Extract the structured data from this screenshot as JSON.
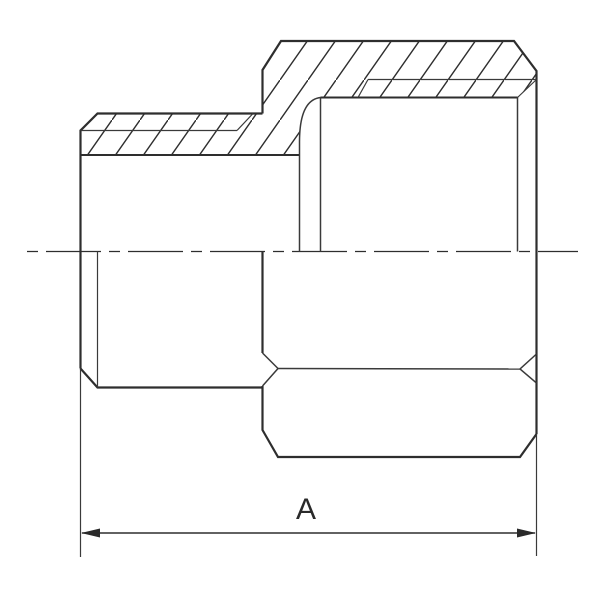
{
  "drawing": {
    "dimension": {
      "label": "A"
    },
    "colors": {
      "background": "#ffffff",
      "line": "#2e2e2e",
      "thin_line": "#3a3a3a",
      "hatch": "#2e2e2e"
    }
  }
}
